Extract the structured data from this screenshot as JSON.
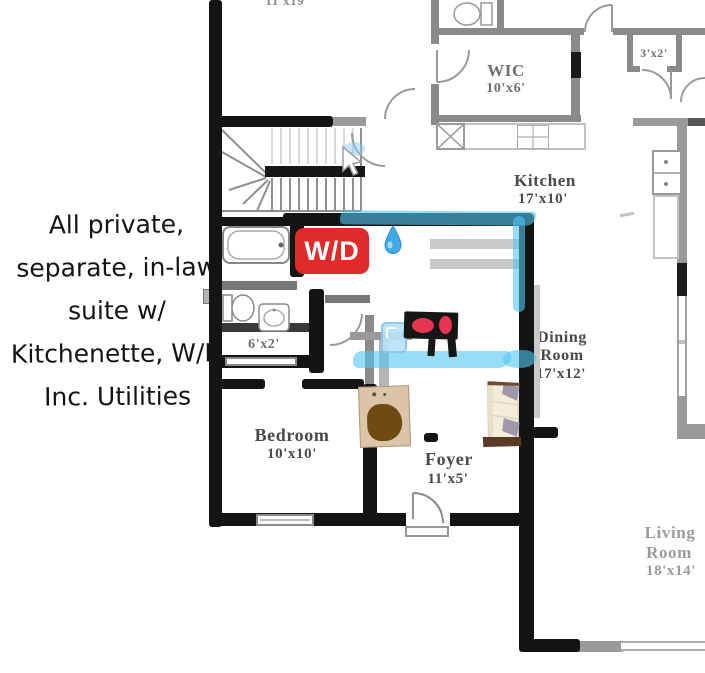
{
  "note": {
    "lines": [
      "All private,",
      "separate, in-law",
      "suite w/",
      "Kitchenette, W/D",
      "Inc. Utilities"
    ]
  },
  "badge": {
    "wd": "W/D"
  },
  "labels": {
    "upper_dims": "11'x19'",
    "wic_name": "WIC",
    "wic_dims": "10'x6'",
    "closet_dims": "3'x2'",
    "kitchen_name": "Kitchen",
    "kitchen_dims": "17'x10'",
    "dining_line1": "Dining",
    "dining_line2": "Room",
    "dining_dims": "17'x12'",
    "bath_closet_dims": "6'x2'",
    "bedroom_name": "Bedroom",
    "bedroom_dims": "10'x10'",
    "foyer_name": "Foyer",
    "foyer_dims": "11'x5'",
    "living_line1": "Living",
    "living_line2": "Room",
    "living_dims": "18'x14'"
  },
  "icons": {
    "water_drop": "water-drop-emoji",
    "ice_cube": "ice-cube-emoji",
    "cursor": "white-arrow-cursor"
  },
  "colors": {
    "wd_badge": "#e12b2b",
    "highlighter": "#50c6f4",
    "marker_wall": "#141414",
    "plan_wall": "#8a8a8a",
    "burner_red": "#e63550",
    "label_dark": "#4a4a4a",
    "label_light": "#9b9b9b"
  }
}
